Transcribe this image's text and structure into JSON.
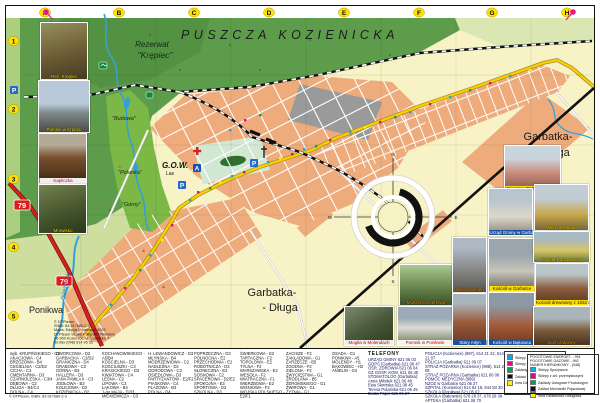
{
  "map": {
    "labels": {
      "forest": "PUSZCZA KOZIENICKA",
      "rezerwat": "Rezerwat",
      "krepiec": "\"Krępiec\"",
      "garbatka_r1": "Garbatka-",
      "garbatka_r2": "- Długa",
      "garbatka_b1": "Garbatka-",
      "garbatka_b2": "- Długa",
      "ponikwa": "Ponikwa",
      "gow": "G.O.W.",
      "gow_sub": "Las",
      "budowa": "\"Budowa\"",
      "polanka": "\"Polanka\"",
      "gorny": "\"Górny\"",
      "river": "Brzeźniczka"
    },
    "grid": {
      "cols": [
        "A",
        "B",
        "C",
        "D",
        "E",
        "F",
        "G",
        "H"
      ],
      "rows": [
        "1",
        "2",
        "3",
        "4",
        "5"
      ]
    },
    "markers": {
      "parking": "P",
      "point_a": "A",
      "road_number": "79"
    },
    "compass": {
      "n": "N",
      "e": "E",
      "s": "S",
      "w": "W"
    },
    "colors": {
      "forest_green": "#5d9c4a",
      "field_green": "#cede9f",
      "built_up": "#eeac7c",
      "main_road_yellow": "#f7d000",
      "route79_red": "#d81e1e",
      "water_blue": "#35a0d8",
      "grid_badge_yellow": "#ffe000"
    }
  },
  "photos": {
    "items": [
      {
        "caption": "Rez. Krępiec"
      },
      {
        "caption": "Pomnik w Krępcu"
      },
      {
        "caption": "Kapliczka"
      },
      {
        "caption": "Mrowisko"
      },
      {
        "caption": "Muszla koncertowa"
      },
      {
        "caption": "Mogiła w Molendach"
      },
      {
        "caption": "Pomnik w Ponikwie"
      },
      {
        "caption": "Dworzec PKP w Garbatce"
      },
      {
        "caption": "Urząd Gminy w Garbatce"
      },
      {
        "caption": "Willa drewniana"
      },
      {
        "caption": "Wieża ciśnień"
      },
      {
        "caption": "Kościół w Garbatce"
      },
      {
        "caption": "Szkoła Podstawowa"
      },
      {
        "caption": "Kościół drewniany z 1932 r."
      },
      {
        "caption": "Stary młyn"
      },
      {
        "caption": "Kościół w Bąkowcu"
      },
      {
        "caption": "Dom zakonny"
      }
    ]
  },
  "index": {
    "columns": [
      [
        "wyb. KRUPIŃSKIEGO - C2",
        "AKACJOWA - C4",
        "BRZOZOWA - B4",
        "CEGIELNIA - C2/D2",
        "CICHA - C3",
        "CMENTARNA - D3",
        "CZARNOLESKA - C3/4",
        "DĘBOWA - C2",
        "DŁUGA - B4/C4",
        "DOLNA - C4"
      ],
      [
        "DWORCOWA - D2",
        "GARBACKA - C2/D2",
        "GRANICZNA - D4",
        "GRABOWA - C3",
        "GÓRNA - B3",
        "HALLERA - D3",
        "JANA PAWŁA II - C3",
        "JODŁOWA - B3",
        "KOLEJOWA - D2",
        "KOZIENICKA - B2"
      ],
      [
        "KOCHANOWSKIEGO - A5/B4",
        "KOŚCIELNA - D3",
        "KOŚCIUSZKI - C3",
        "KRASICKIEGO - D3",
        "KWIATOWA - C4",
        "LEŚNA - C2",
        "LIPOWA - C3",
        "ŁĄKOWA - B4",
        "1-go MAJA - D2/3",
        "MICKIEWICZA - C3"
      ],
      [
        "H. LEWANDOWICZ - D3",
        "MŁYŃSKA - B4",
        "MODRZEWIOWA - C2",
        "NADLEŚNA - D2",
        "OGRODOWA - C3",
        "OSIEDLOWA - D3",
        "PARTYZANTÓW - E2/F2",
        "PIASKOWA - C4",
        "PLAŻOWA - B3",
        "POLNA - D4"
      ],
      [
        "POPRZECZNA - D3",
        "PÓŁNOCNA - E2",
        "PRZECHODNIA - E2",
        "ROBOTNICZA - D3",
        "SŁONECZNA - E2",
        "SOSNOWA - C2",
        "SPACEROWA - D2/E2",
        "SPOKOJNA - E3",
        "SPORTOWA - D3",
        "SZKOLNA - D3"
      ],
      [
        "ŚWIERKOWA - E2",
        "TARTACZNA - F2",
        "TOPOLOWA - E2",
        "TYLNA - F2",
        "WARSZAWSKA - E2",
        "WESOŁA - F2",
        "WIATRACZNA - F1",
        "WIERZBOWA - E2",
        "WIŚNIOWA - F2",
        "WOJSKA POLSKIEGO - E2/F1"
      ],
      [
        "ZACISZE - F2",
        "ZAKŁADOWA - G1",
        "ZARZECZE - B5",
        "ZGODNA - F2",
        "ZIELONA - F2",
        "ZWYCIĘSTWA - G1",
        "ŹRÓDLANA - B5",
        "ŻEROMSKIEGO - G1",
        "ŻWIROWA - G1",
        "ŻYTNIA - G1"
      ],
      [
        "OSADA - G1",
        "PONIKWA - A5",
        "MOLENDY - H1",
        "BĄKOWIEC - H3",
        "ANIELIN - G4"
      ]
    ]
  },
  "phones": {
    "title": "TELEFONY",
    "col1": [
      "URZĄD GMINY 621 06 03",
      "GOPS (Garbatka) 621 06 47",
      "OŚR. ZDROWIA 621 06 04",
      "GZ GOSP. KOM. 621 06 45",
      "STOMATOLOG (Garbatka):",
      "Anna Mikołek 621 06 48",
      "Ewa Skwirska 621 08 45",
      "Teresa Polańska 621 06 45",
      "Beata Papis 621 06 27"
    ],
    "col2": [
      "POLICJA (Kozienice) (997), 614 21 22, 614 21 07",
      "POLICJA (Garbatka) 621 06 07",
      "STRAŻ POŻARNA (Kozienice) (998), 614 21 08",
      "STRAŻ POŻARNA (Garbatka) 621 06 08",
      "POMOC MEDYCZNA (999)",
      "NZOZ w Garbatce 621 06 27",
      "SZPITAL (Kozienice) 614 62 18, 644 83 30",
      "SZKOŁA (Ponikwa) 621 05 67",
      "SZKOŁA (Bąkowiec) 678 28 37, 678 28 38",
      "APTEKA (Garbatka) 621 06 70"
    ]
  },
  "legend": {
    "left": {
      "items": [
        {
          "color": "#00aeef",
          "label": "Sklepy Spożywcze"
        },
        {
          "color": "#ec008c",
          "label": "Sklepy z art. przem."
        },
        {
          "color": "#00a651",
          "label": "Zakłady Usługowe"
        },
        {
          "color": "#111111",
          "label": "Zakład Mech. Pojazdowej"
        },
        {
          "color": "#fff200",
          "label": "Inna Działalność Usług."
        }
      ]
    },
    "right": {
      "header": [
        "POGOTOWIE ENERGET. - 991",
        "POGOTOWIE GAZOWE - 992",
        "NUMER KIERUNKOWY - (048)"
      ],
      "items": [
        {
          "color": "#00aeef",
          "label": "Sklepy Spożywcze"
        },
        {
          "color": "#ec008c",
          "label": "Sklepy z art. przemysłowymi"
        },
        {
          "color": "#00a651",
          "label": "Zakłady Usługowe Produkcyjne"
        },
        {
          "color": "#111111",
          "label": "Zakład Mechaniki Pojazdowej"
        },
        {
          "color": "#fff200",
          "label": "Inna Działalność Usługowa"
        }
      ]
    }
  },
  "publisher": {
    "lines": [
      "© DTPteam",
      "ISBN: 83-917680-2-3",
      "Mapa. Edycja I, czerwiec 2003",
      "DTPteam Studio Poligrafii i Reklamy",
      "26-900 Kozienice, ul. Lubelska 4",
      "tel./fax (048) 614 95 55"
    ]
  },
  "footer": {
    "text": "© DTPteam,   ISBN: 83-917680-2-3"
  }
}
